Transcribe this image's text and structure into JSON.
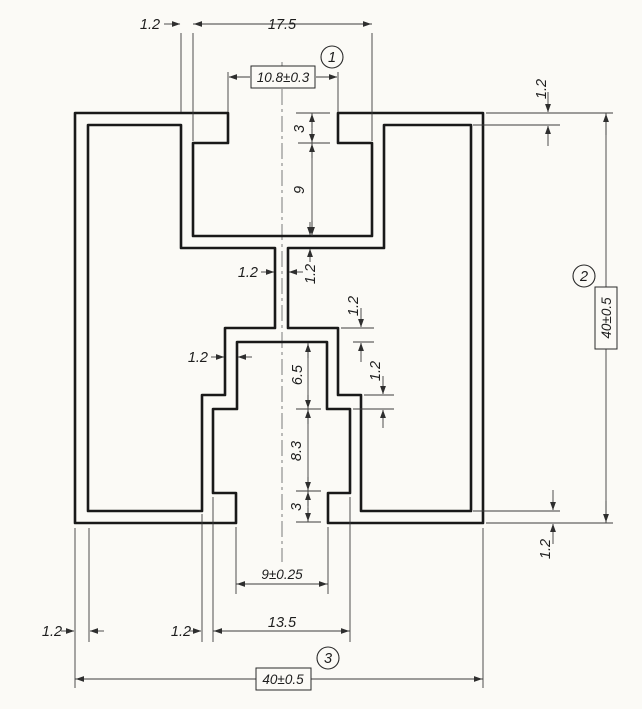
{
  "drawing": {
    "type": "technical-drawing",
    "subject": "aluminium extrusion profile cross-section",
    "colors": {
      "ink": "#191919",
      "thin_line": "#3c3c3c",
      "paper": "#fbfaf6"
    },
    "balloons": {
      "b1": "1",
      "b2": "2",
      "b3": "3"
    },
    "dimensions": {
      "wall_top_left": "1.2",
      "top_cavity_width": "17.5",
      "top_slot_opening": "10.8±0.3",
      "top_lip_depth": "3",
      "top_cavity_depth": "9",
      "wall_top_right": "1.2",
      "overall_height": "40±0.5",
      "web_thickness": "1.2",
      "top_block_bottom_wall": "1.2",
      "block_left_wall": "1.2",
      "block_top_wall_right": "1.2",
      "recess_depth": "6.5",
      "foot_step_wall": "1.2",
      "mid_cavity_depth": "8.3",
      "bottom_lip_depth": "3",
      "wall_bottom_right": "1.2",
      "bottom_opening": "9±0.25",
      "wall_bottom_left": "1.2",
      "foot_wall_bottom": "1.2",
      "bottom_cavity_width": "13.5",
      "overall_width": "40±0.5"
    }
  }
}
